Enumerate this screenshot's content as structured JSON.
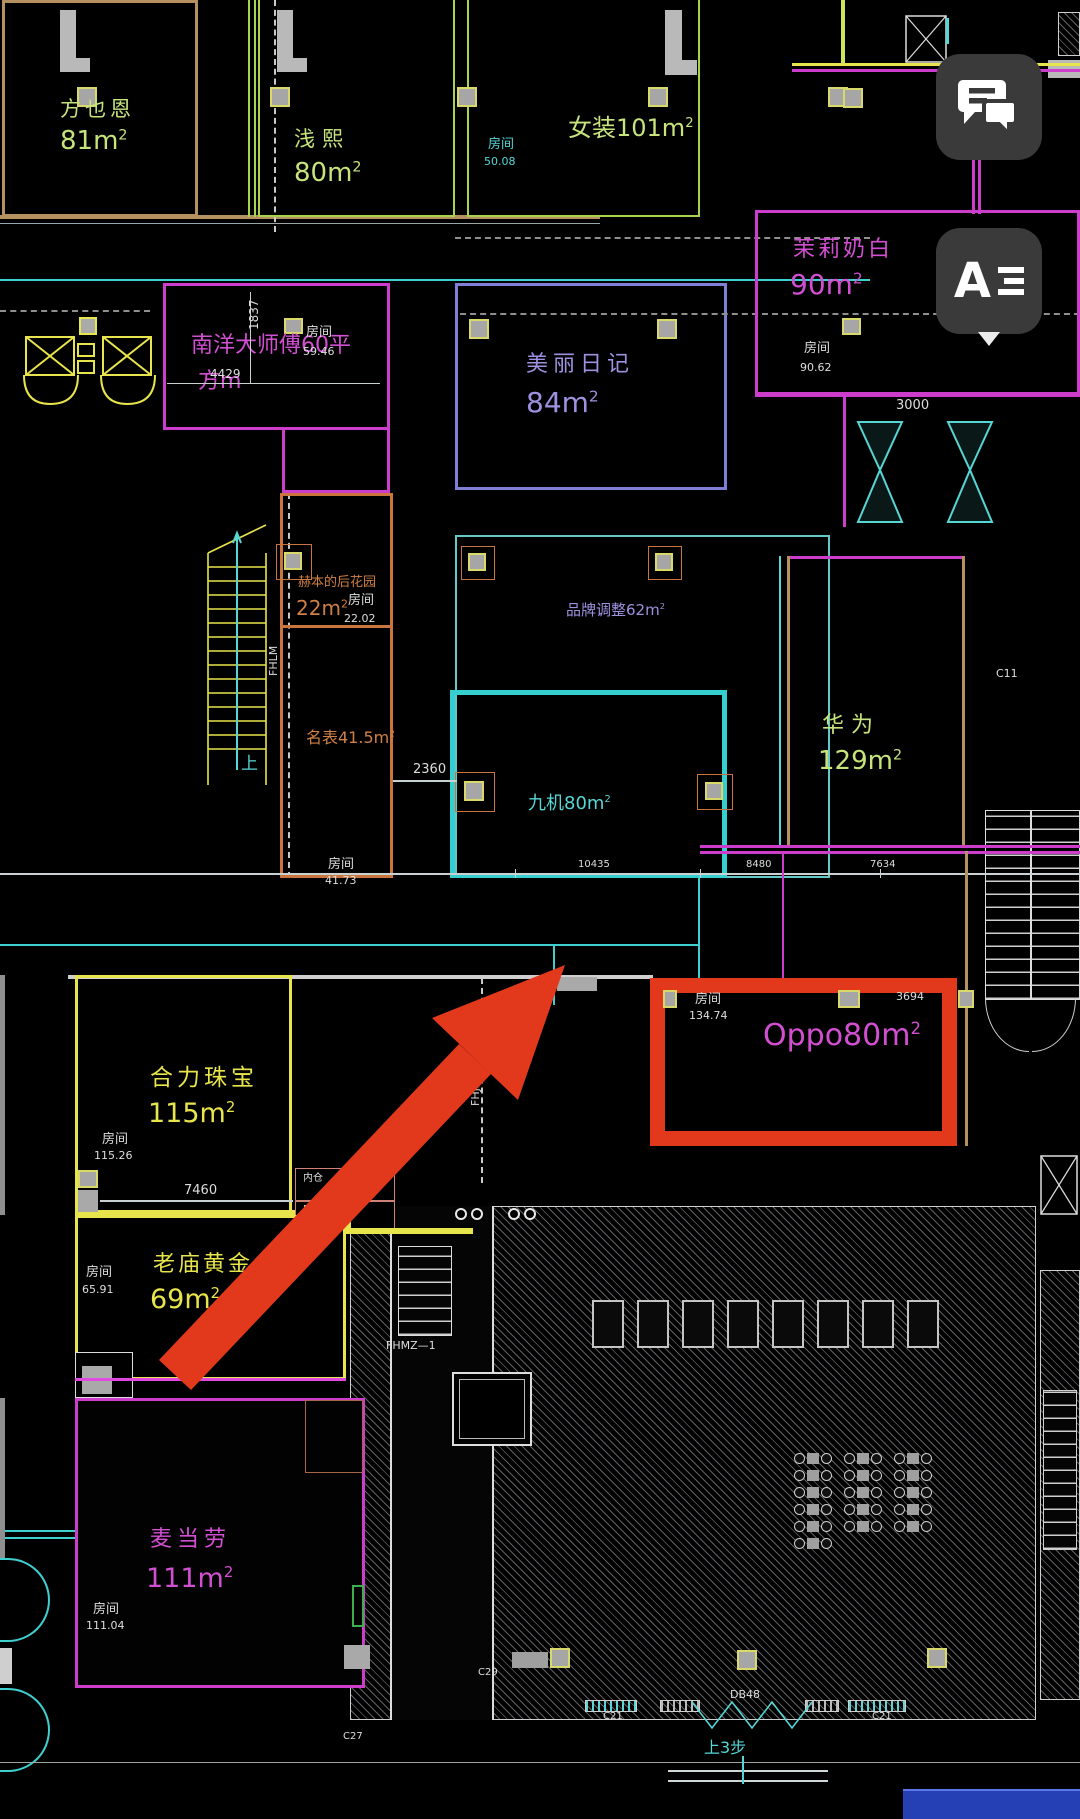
{
  "misc": {
    "sup2": "2"
  },
  "buttons": {
    "layers_letter": "A"
  },
  "rooms": {
    "fangyeen": {
      "name": "方也恩",
      "area": "81m"
    },
    "qianxi": {
      "name": "浅熙",
      "area": "80m"
    },
    "nvzhuang": {
      "label": "女装101m"
    },
    "molinaibai": {
      "name": "茉莉奶白",
      "area": "90m"
    },
    "nanyang": {
      "line1": "南洋大师傅60平",
      "line2": "方m"
    },
    "meiliriji": {
      "name": "美丽日记",
      "area": "84m"
    },
    "hebenhuayuan": {
      "name": "赫本的后花园",
      "area": "22m"
    },
    "pinpaitiaozheng": {
      "label": "品牌调整62m"
    },
    "mingbiao": {
      "label": "名表41.5m"
    },
    "jiuji": {
      "label": "九机80m"
    },
    "huawei": {
      "name": "华为",
      "area": "129m"
    },
    "oppo": {
      "label": "Oppo80m"
    },
    "helizhubao": {
      "name": "合力珠宝",
      "area": "115m"
    },
    "laomiaohuangjin": {
      "name": "老庙黄金",
      "area": "69m"
    },
    "maidanglao": {
      "name": "麦当劳",
      "area": "111m"
    }
  },
  "room_tags": {
    "label": "房间",
    "r5008": "50.08",
    "r5946": "59.46",
    "r9062": "90.62",
    "r2202": "22.02",
    "r4173": "41.73",
    "r7786": "77.86",
    "r13474": "134.74",
    "r11526": "115.26",
    "r6591": "65.91",
    "r11104": "111.04"
  },
  "dimensions": {
    "d4429": "4429",
    "d1837": "1837",
    "d2360": "2360",
    "d3000": "3000",
    "d7460": "7460",
    "d3694": "3694",
    "d10435": "10435",
    "d8480": "8480",
    "d7634": "7634"
  },
  "annotations": {
    "fhlm": "FHLM",
    "fhjm": "FHJM",
    "fhmz": "FHMZ—1",
    "up": "上",
    "steps_up": "上3步",
    "steps_down": "下2步",
    "db48": "DB48",
    "c21": "C21",
    "c27": "C27",
    "c29": "C29",
    "c11": "C11",
    "neicang": "内仓"
  },
  "colors": {
    "accent_red": "#e2391d",
    "text_green": "#c6e37c",
    "text_yellow": "#e8e44c",
    "text_magenta": "#d24fd2",
    "text_violet": "#9e92e0",
    "text_cyan": "#57d6d6",
    "text_orange": "#d08045",
    "button_bg": "#3a3a3a"
  }
}
